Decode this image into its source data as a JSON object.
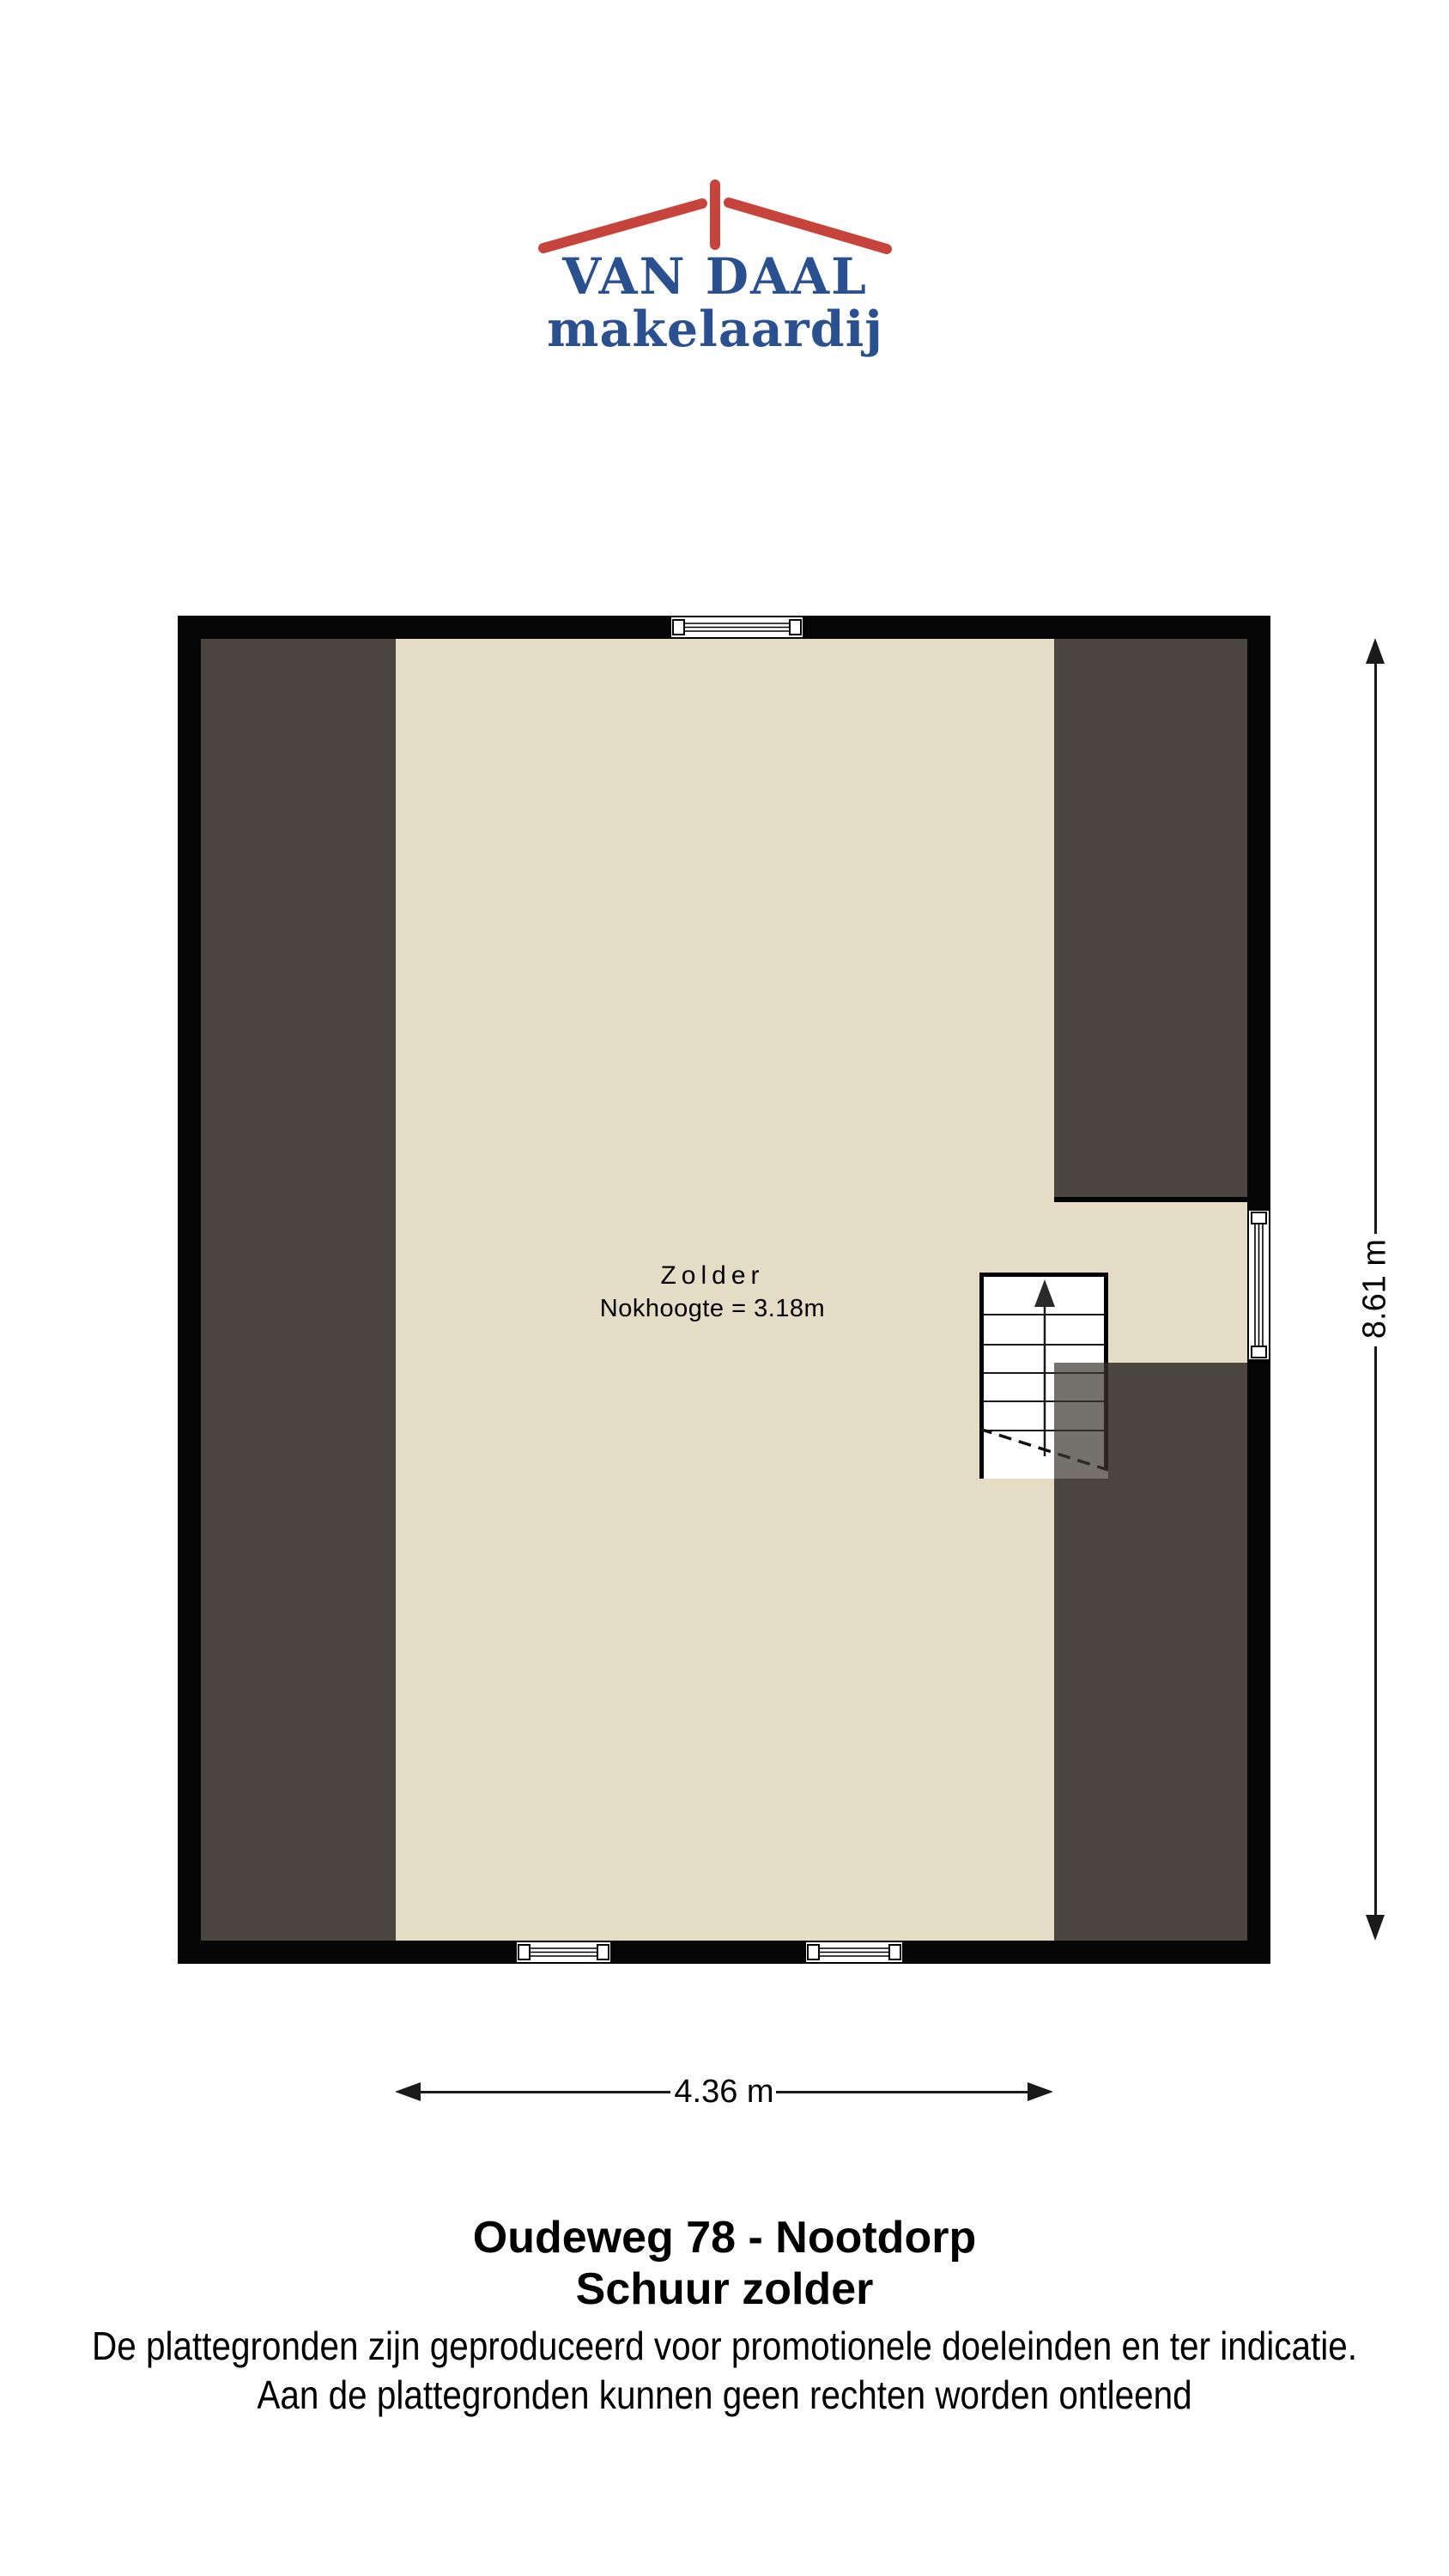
{
  "logo": {
    "brand": "VAN DAAL",
    "tagline": "makelaardij"
  },
  "floorplan": {
    "room_label": "Zolder",
    "ridge_height_label": "Nokhoogte = 3.18m",
    "ridge_height_m": 3.18,
    "windows": [
      "top-wall",
      "bottom-wall-left",
      "bottom-wall-right",
      "right-wall"
    ],
    "staircase_direction": "up"
  },
  "dimensions": {
    "vertical_label": "8.61 m",
    "horizontal_label": "4.36 m",
    "depth_m": 8.61,
    "width_m": 4.36
  },
  "footer": {
    "address": "Oudeweg 78 - Nootdorp",
    "floor_name": "Schuur zolder",
    "disclaimer_line1": "De plattegronden zijn geproduceerd voor promotionele doeleinden en ter indicatie.",
    "disclaimer_line2": "Aan de plattegronden kunnen geen rechten worden ontleend"
  },
  "colors": {
    "floor": "#e4dcc5",
    "roof": "#4a463f",
    "wall": "#060606",
    "brand_blue": "#2b5090",
    "brand_red": "#c7443c",
    "dimension_line": "#1a1a1a"
  }
}
